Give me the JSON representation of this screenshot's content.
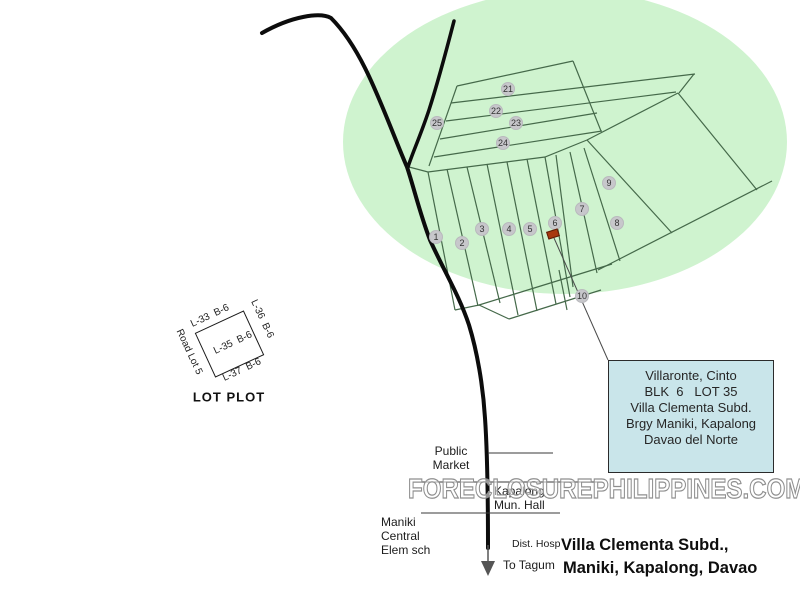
{
  "map": {
    "region_color": "#cff3cf",
    "line_color": "#45694a",
    "marker_fill": "#c7c7cb",
    "markers": [
      {
        "n": "1",
        "x": 436,
        "y": 237
      },
      {
        "n": "2",
        "x": 462,
        "y": 243
      },
      {
        "n": "3",
        "x": 482,
        "y": 229
      },
      {
        "n": "4",
        "x": 509,
        "y": 229
      },
      {
        "n": "5",
        "x": 530,
        "y": 229
      },
      {
        "n": "6",
        "x": 555,
        "y": 223
      },
      {
        "n": "7",
        "x": 582,
        "y": 209
      },
      {
        "n": "8",
        "x": 617,
        "y": 223
      },
      {
        "n": "9",
        "x": 609,
        "y": 183
      },
      {
        "n": "10",
        "x": 582,
        "y": 296
      },
      {
        "n": "21",
        "x": 508,
        "y": 89
      },
      {
        "n": "22",
        "x": 496,
        "y": 111
      },
      {
        "n": "23",
        "x": 516,
        "y": 123
      },
      {
        "n": "24",
        "x": 503,
        "y": 143
      },
      {
        "n": "25",
        "x": 437,
        "y": 123
      }
    ],
    "subject_marker": {
      "x": 553,
      "y": 234,
      "color": "#a8380f"
    }
  },
  "lot_plot": {
    "caption": "LOT PLOT",
    "top_label": "L-33  B-6",
    "center_label": "L-35  B-6",
    "bottom_label": "L-37  B-6",
    "right_label": "L-36  B-6",
    "left_label": "Road Lot 5"
  },
  "info_box": {
    "bg": "#c9e5ea",
    "lines": [
      "Villaronte, Cinto",
      "BLK  6   LOT 35",
      "Villa Clementa Subd.",
      "Brgy Maniki, Kapalong",
      "Davao del Norte"
    ]
  },
  "labels": {
    "public_market": "Public\nMarket",
    "kapalong_hall": "Kapalong\nMun. Hall",
    "maniki_school": "Maniki\nCentral\nElem sch",
    "dist_hosp": "Dist. Hosp",
    "to_tagum": "To Tagum"
  },
  "title": {
    "line1": "Villa Clementa Subd.,",
    "line2": "Maniki, Kapalong, Davao"
  },
  "watermark": "FORECLOSUREPHILIPPINES.COM"
}
